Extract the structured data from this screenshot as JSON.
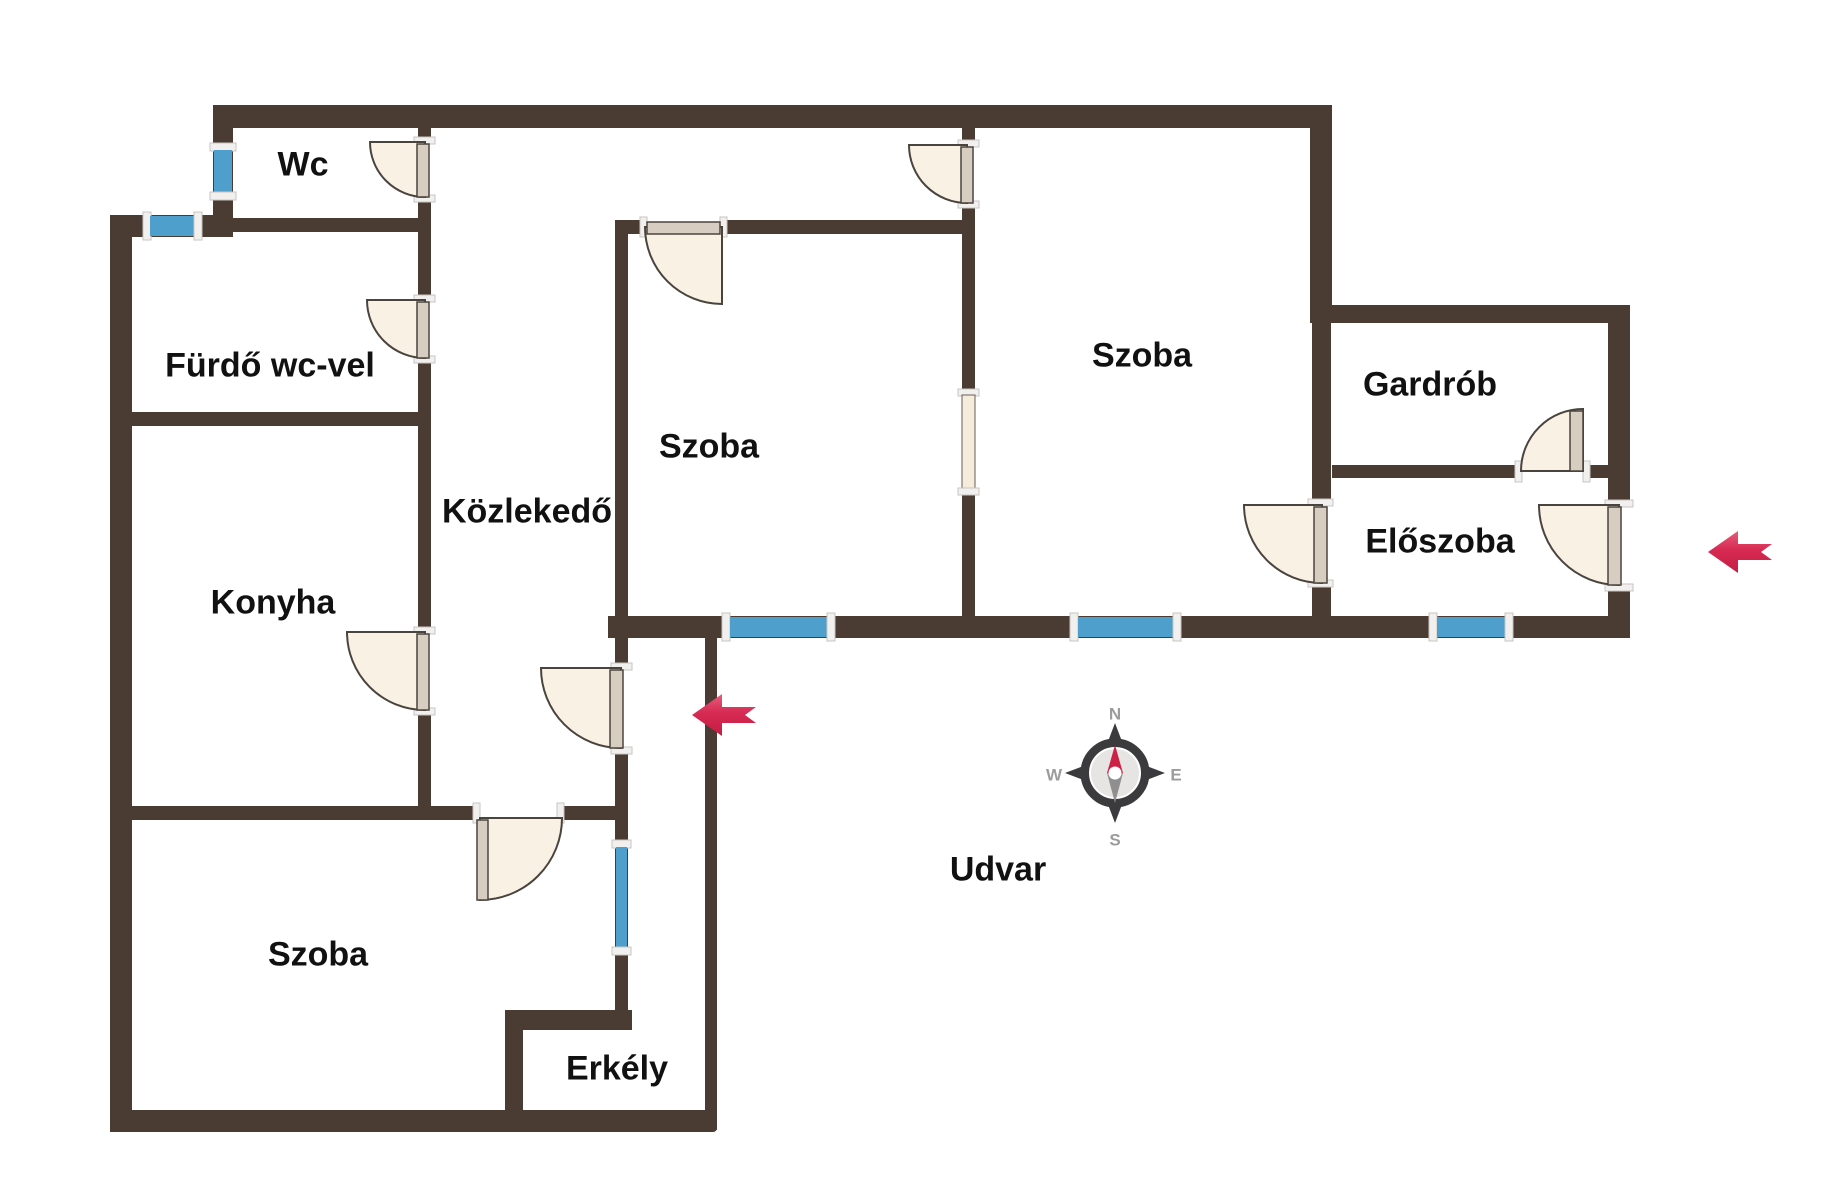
{
  "colors": {
    "wall": "#4a3c33",
    "window_glass": "#4e9fcb",
    "window_frame": "#f2f0ee",
    "door_fill": "#faf1e5",
    "door_leaf": "#d7cec1",
    "door_stroke": "#4a443e",
    "arrow_red": "#d62a52",
    "compass_dark": "#3b3b3e",
    "compass_inner": "#e6e5e3",
    "compass_letter": "#9c9c9c",
    "needle_north": "#cc2144",
    "needle_south": "#8f8f8f",
    "label_color": "#111111",
    "background": "#ffffff"
  },
  "rooms": [
    {
      "id": "wc",
      "label": "Wc"
    },
    {
      "id": "furdo",
      "label": "Fürdő wc-vel"
    },
    {
      "id": "konyha",
      "label": "Konyha"
    },
    {
      "id": "szoba-bal",
      "label": "Szoba"
    },
    {
      "id": "kozlekedo",
      "label": "Közlekedő"
    },
    {
      "id": "szoba-kozep",
      "label": "Szoba"
    },
    {
      "id": "szoba-jobb",
      "label": "Szoba"
    },
    {
      "id": "gardrob",
      "label": "Gardrób"
    },
    {
      "id": "eloszoba",
      "label": "Előszoba"
    },
    {
      "id": "erkely",
      "label": "Erkély"
    },
    {
      "id": "udvar",
      "label": "Udvar"
    }
  ],
  "compass": {
    "n": "N",
    "e": "E",
    "s": "S",
    "w": "W"
  }
}
